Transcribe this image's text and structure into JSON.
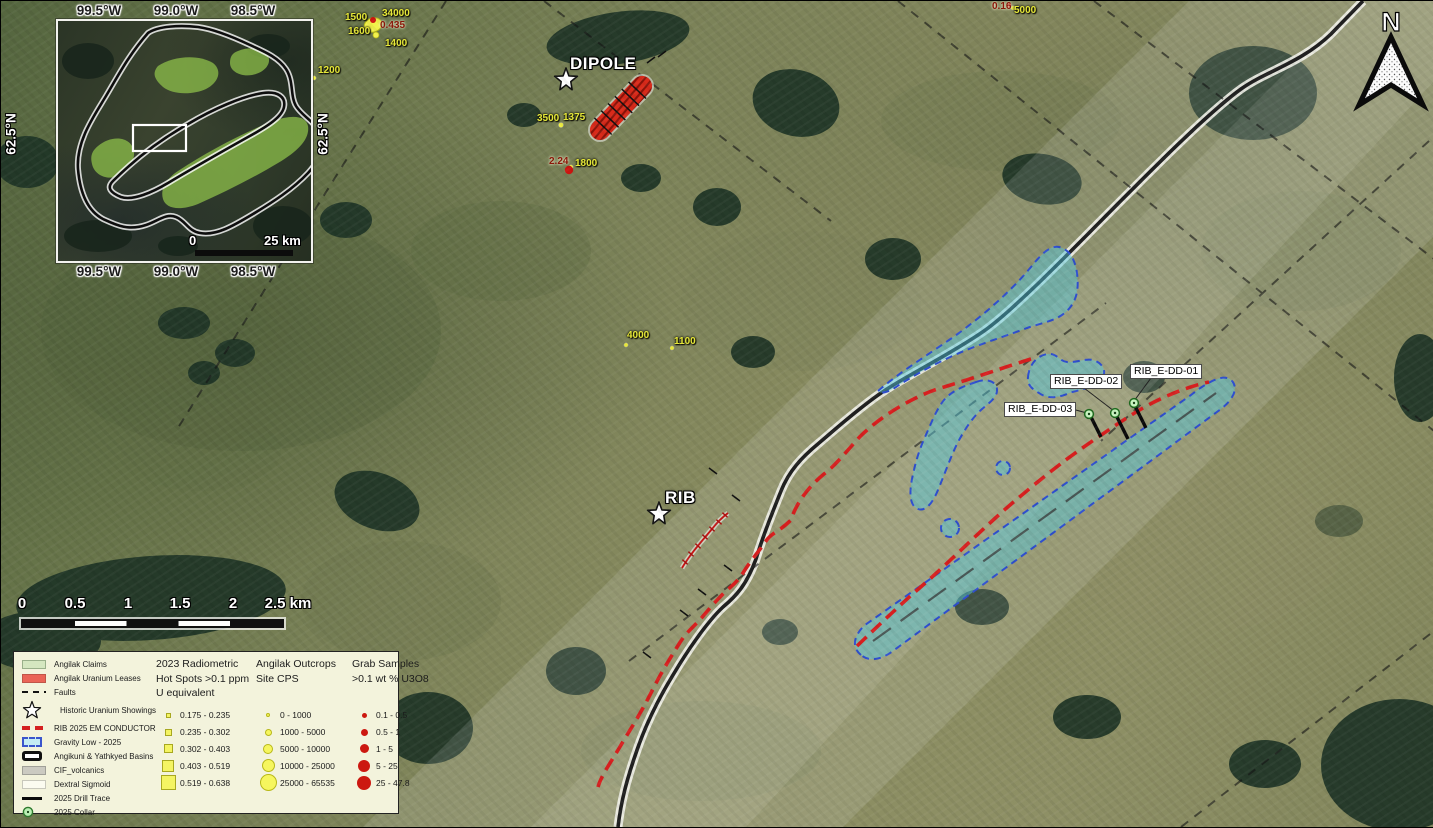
{
  "map": {
    "north_label": "N",
    "stations": [
      {
        "name": "DIPOLE",
        "label_x": 569,
        "label_y": 53
      },
      {
        "name": "RIB",
        "label_x": 664,
        "label_y": 487
      }
    ],
    "drill_holes": [
      {
        "label": "RIB_E-DD-01",
        "x": 1129,
        "y": 363
      },
      {
        "label": "RIB_E-DD-02",
        "x": 1049,
        "y": 373
      },
      {
        "label": "RIB_E-DD-03",
        "x": 1003,
        "y": 401
      }
    ],
    "spot_labels": [
      {
        "text": "1500",
        "color": "yellow",
        "x": 344,
        "y": 12
      },
      {
        "text": "34000",
        "color": "yellow",
        "x": 381,
        "y": 8
      },
      {
        "text": "0.435",
        "color": "red",
        "x": 379,
        "y": 20
      },
      {
        "text": "1600",
        "color": "yellow",
        "x": 347,
        "y": 26
      },
      {
        "text": "1400",
        "color": "yellow",
        "x": 384,
        "y": 38
      },
      {
        "text": "1200",
        "color": "yellow",
        "x": 317,
        "y": 65
      },
      {
        "text": "3500",
        "color": "yellow",
        "x": 536,
        "y": 113
      },
      {
        "text": "1375",
        "color": "yellow",
        "x": 562,
        "y": 112
      },
      {
        "text": "2.24",
        "color": "red",
        "x": 548,
        "y": 156
      },
      {
        "text": "1800",
        "color": "yellow",
        "x": 574,
        "y": 158
      },
      {
        "text": "4000",
        "color": "yellow",
        "x": 626,
        "y": 330
      },
      {
        "text": "1100",
        "color": "yellow",
        "x": 673,
        "y": 336
      },
      {
        "text": "0.16",
        "color": "red",
        "x": 991,
        "y": 1
      },
      {
        "text": "5000",
        "color": "yellow",
        "x": 1013,
        "y": 5
      }
    ],
    "scale_bar": {
      "ticks": [
        {
          "t": "0",
          "x": 21
        },
        {
          "t": "0.5",
          "x": 74
        },
        {
          "t": "1",
          "x": 127
        },
        {
          "t": "1.5",
          "x": 179
        },
        {
          "t": "2",
          "x": 232
        },
        {
          "t": "2.5 km",
          "x": 287
        }
      ]
    }
  },
  "inset": {
    "top_labels": [
      {
        "t": "99.5°W",
        "x": 98
      },
      {
        "t": "99.0°W",
        "x": 175
      },
      {
        "t": "98.5°W",
        "x": 252
      }
    ],
    "bottom_labels": [
      {
        "t": "99.5°W",
        "x": 98
      },
      {
        "t": "99.0°W",
        "x": 175
      },
      {
        "t": "98.5°W",
        "x": 252
      }
    ],
    "side_labels": [
      {
        "t": "62.5°N",
        "x": 10,
        "y": 133
      },
      {
        "t": "62.5°N",
        "x": 322,
        "y": 133
      }
    ],
    "scale_zero": "0",
    "scale_text": "25 km"
  },
  "legend": {
    "items": [
      {
        "label": "Angilak Claims",
        "sym": "claims"
      },
      {
        "label": "Angilak Uranium Leases",
        "sym": "leases"
      },
      {
        "label": "Faults",
        "sym": "faults"
      },
      {
        "label": "Historic Uranium Showings",
        "sym": "star"
      },
      {
        "label": "RIB 2025 EM CONDUCTOR",
        "sym": "em"
      },
      {
        "label": "Gravity Low - 2025",
        "sym": "gravity"
      },
      {
        "label": "Angikuni & Yathkyed Basins",
        "sym": "basins"
      },
      {
        "label": "CIF_volcanics",
        "sym": "volcanics"
      },
      {
        "label": "Dextral Sigmoid",
        "sym": "sigmoid"
      },
      {
        "label": "2025 Drill Trace",
        "sym": "drill"
      },
      {
        "label": "2025 Collar",
        "sym": "collar"
      }
    ],
    "radiometric_title": "2023 Radiometric Hot Spots >0.1 ppm U equivalent",
    "radiometric_classes": [
      "0.175 - 0.235",
      "0.235 - 0.302",
      "0.302 - 0.403",
      "0.403 - 0.519",
      "0.519 - 0.638"
    ],
    "outcrops_title": "Angilak Outcrops Site CPS",
    "outcrops_classes": [
      "0 - 1000",
      "1000 - 5000",
      "5000 - 10000",
      "10000 - 25000",
      "25000 - 65535"
    ],
    "grab_title": "Grab Samples >0.1 wt % U3O8",
    "grab_classes": [
      "0.1 - 0.5",
      "0.5 - 1",
      "1 - 5",
      "5 - 25",
      "25 - 47.8"
    ]
  },
  "colors": {
    "conductor_red": "#d81f1f",
    "gravity_fill": "#50cde4",
    "gravity_stroke": "#2f4fd0",
    "label_yellow": "#e6e83a",
    "label_dark_red": "#8a1608",
    "lease_red": "#d92a1a",
    "legend_bg": "#f3f3dc"
  }
}
